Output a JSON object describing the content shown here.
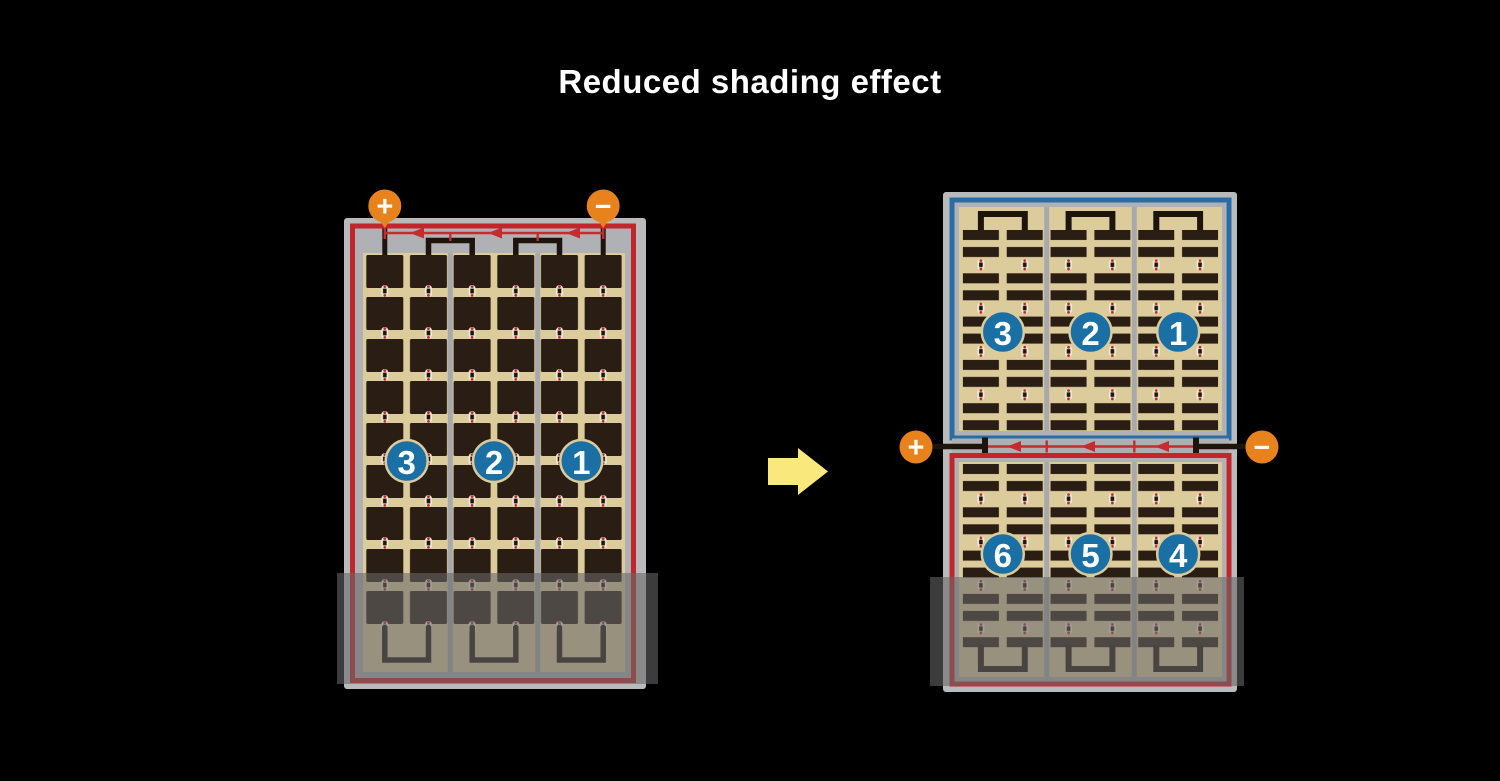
{
  "title": {
    "text": "Reduced shading effect"
  },
  "colors": {
    "background": "#000000",
    "title_text": "#ffffff",
    "frame_gray": "#b9babc",
    "inner_gray": "#b0b1b4",
    "panel_tan": "#dccb9b",
    "cell_dark": "#2a1e14",
    "divider_gray": "#a7a9ac",
    "border_red": "#c0262c",
    "border_blue": "#2a6da4",
    "diode_red": "#c62b2f",
    "wire_black": "#1d140c",
    "terminal_orange": "#e8821d",
    "badge_blue": "#1a6fa4",
    "shading_overlay": "rgba(104,104,104,0.58)",
    "arrow_yellow": "#f9e87c"
  },
  "left_panel": {
    "positive_terminal": "+",
    "negative_terminal": "−",
    "string_badges": [
      "3",
      "2",
      "1"
    ]
  },
  "right_panel": {
    "positive_terminal": "+",
    "negative_terminal": "−",
    "top_half_badges": [
      "3",
      "2",
      "1"
    ],
    "bottom_half_badges": [
      "6",
      "5",
      "4"
    ]
  }
}
